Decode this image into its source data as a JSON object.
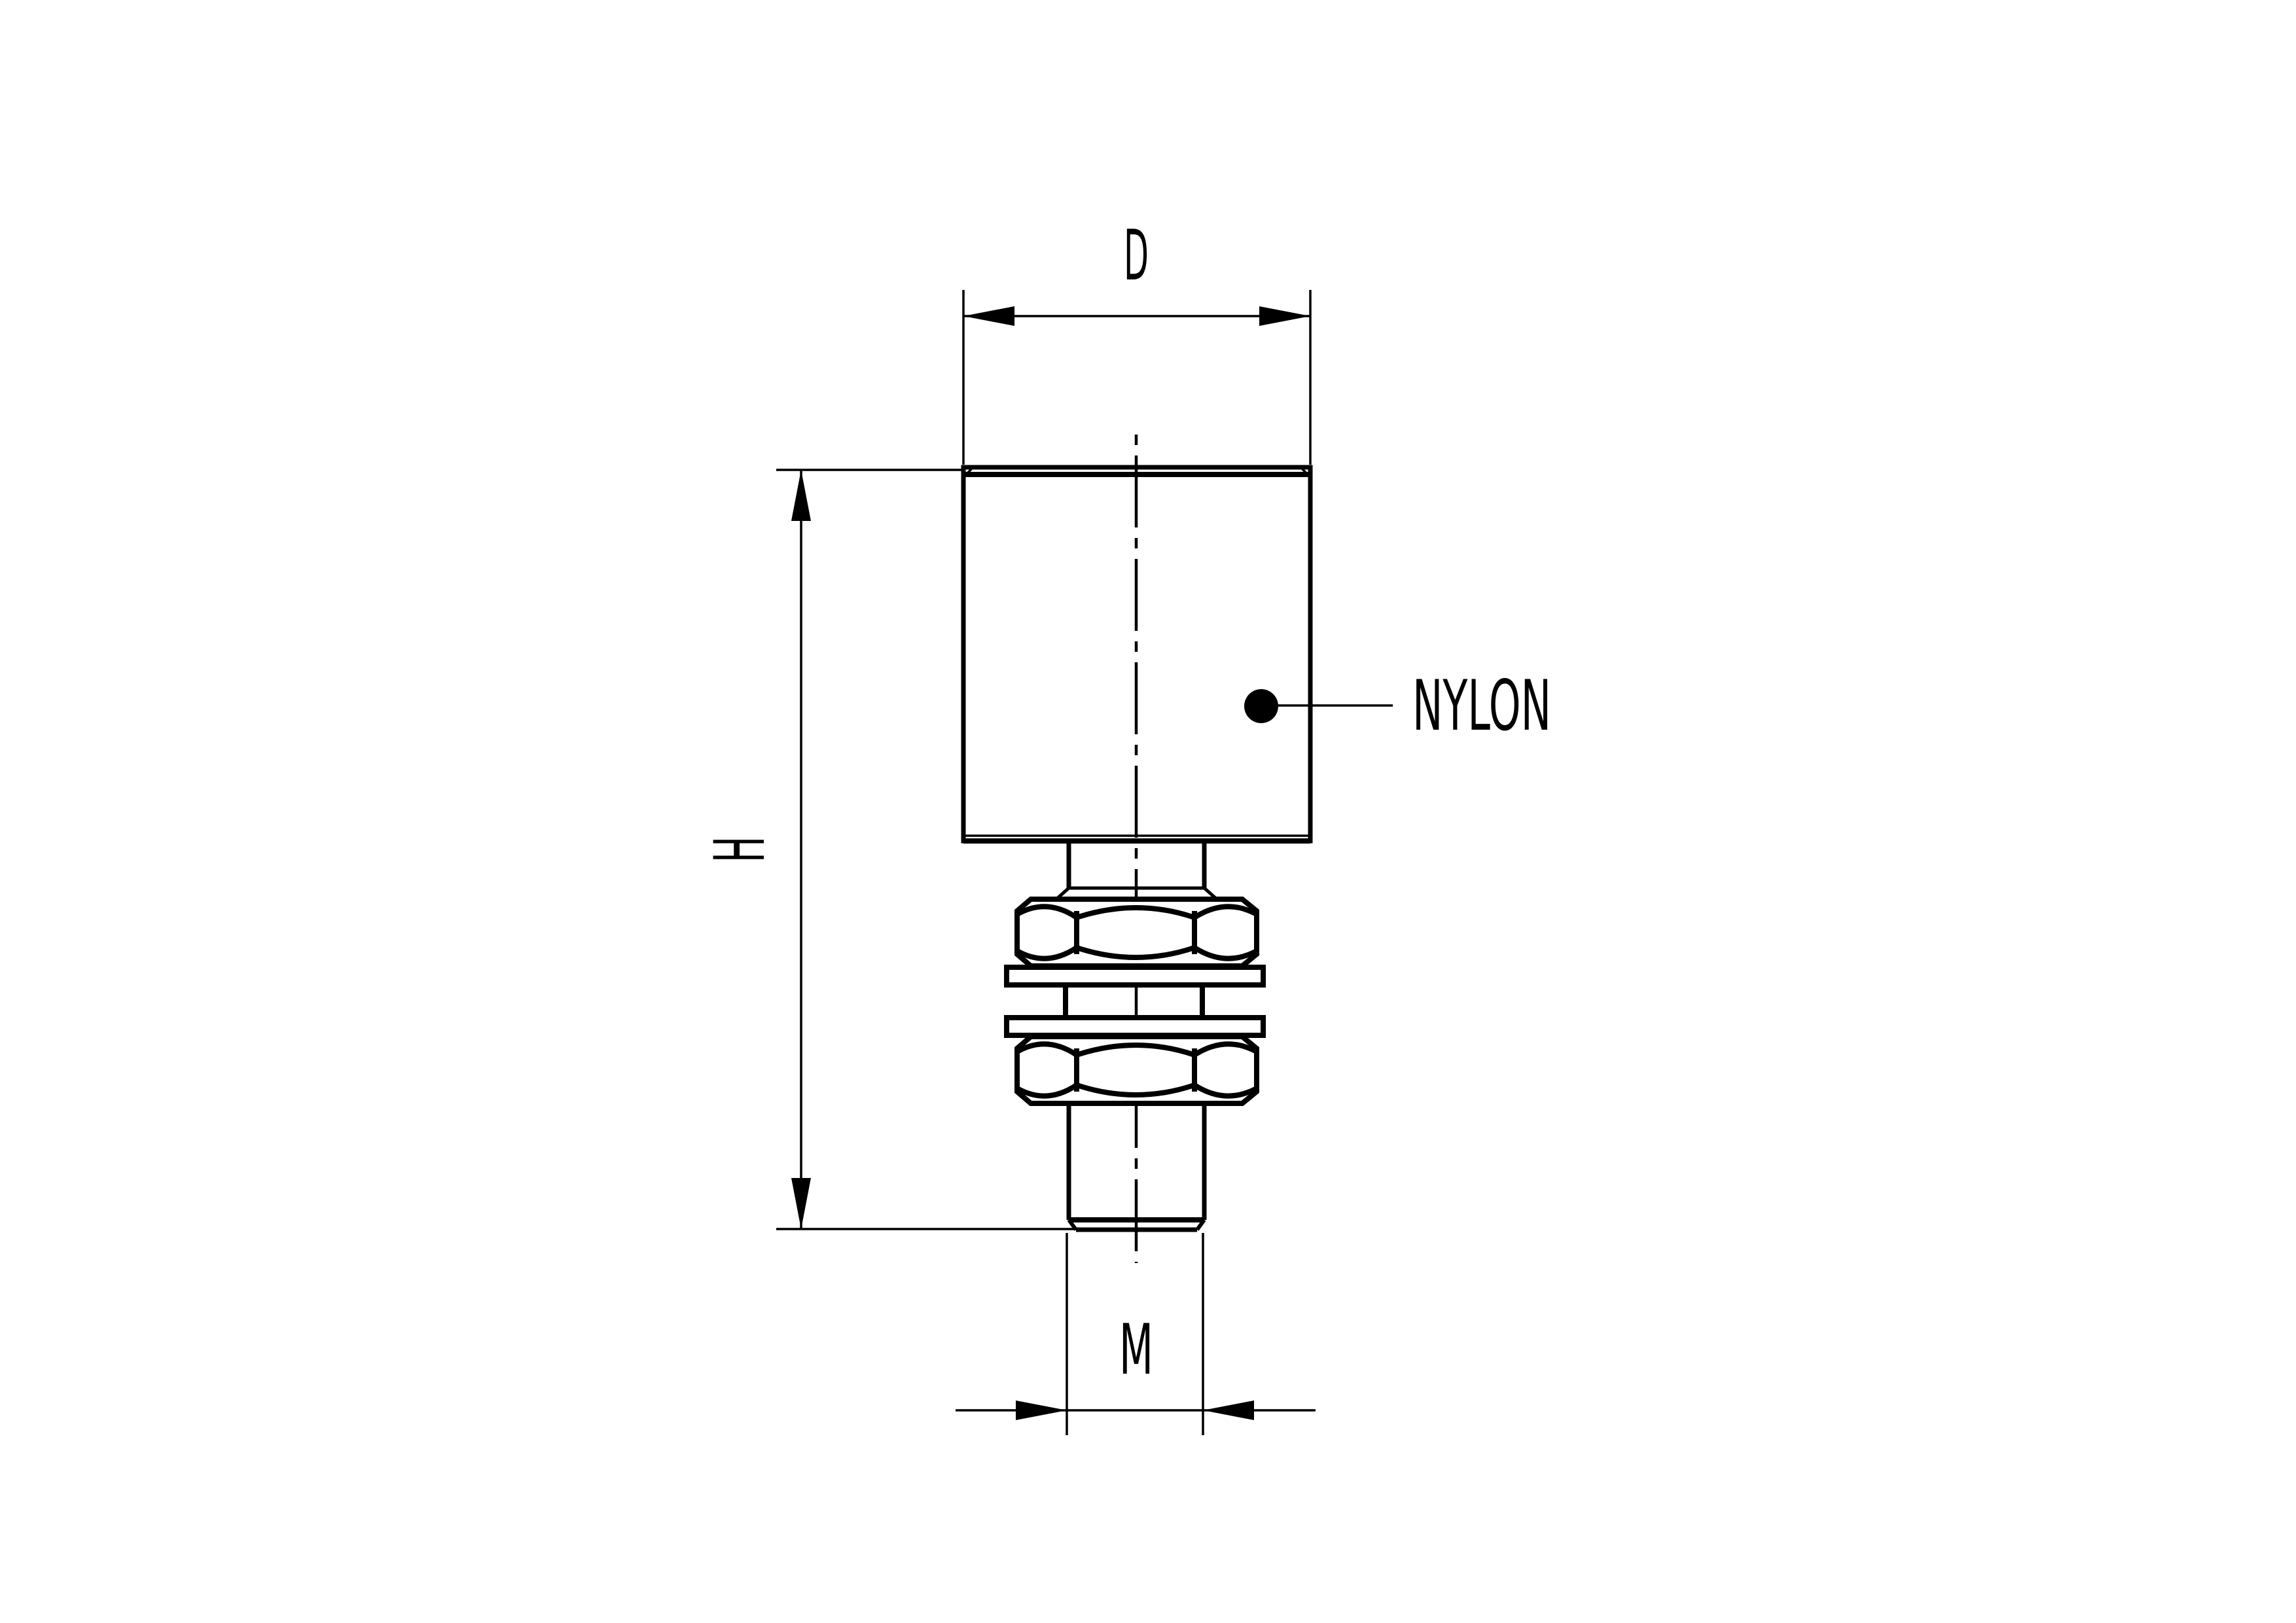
{
  "drawing": {
    "labels": {
      "diameter": "D",
      "height": "H",
      "thread": "M",
      "material": "NYLON"
    },
    "colors": {
      "ink": "#000000",
      "paper": "#ffffff"
    }
  }
}
